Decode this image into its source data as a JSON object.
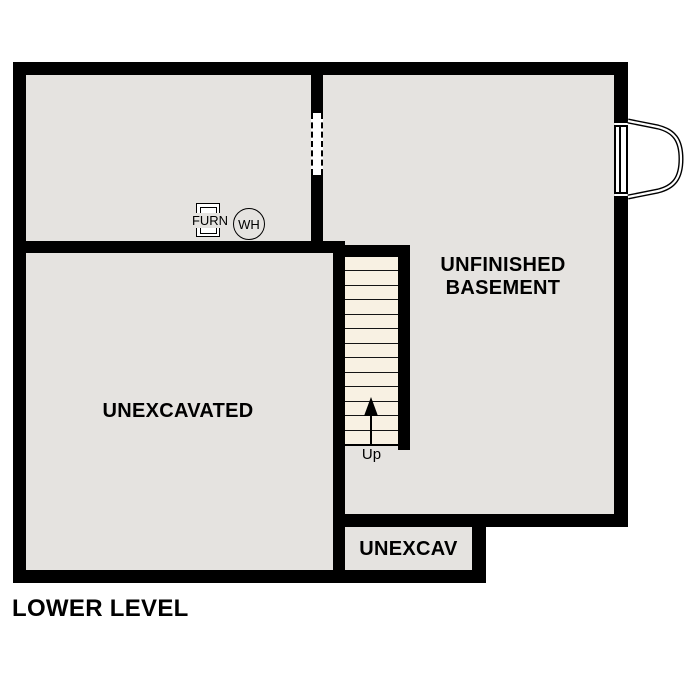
{
  "title": "LOWER LEVEL",
  "colors": {
    "wall": "#000000",
    "room_fill": "#e5e3e0",
    "stair_fill": "#f8f1e3",
    "background": "#ffffff"
  },
  "rooms": {
    "basement": {
      "label_line1": "UNFINISHED",
      "label_line2": "BASEMENT"
    },
    "unexcavated": {
      "label": "UNEXCAVATED"
    },
    "unexcav_small": {
      "label": "UNEXCAV"
    }
  },
  "fixtures": {
    "furnace": {
      "label": "FURN"
    },
    "water_heater": {
      "label": "WH"
    }
  },
  "stairs": {
    "direction_label": "Up",
    "tread_count": 13
  }
}
